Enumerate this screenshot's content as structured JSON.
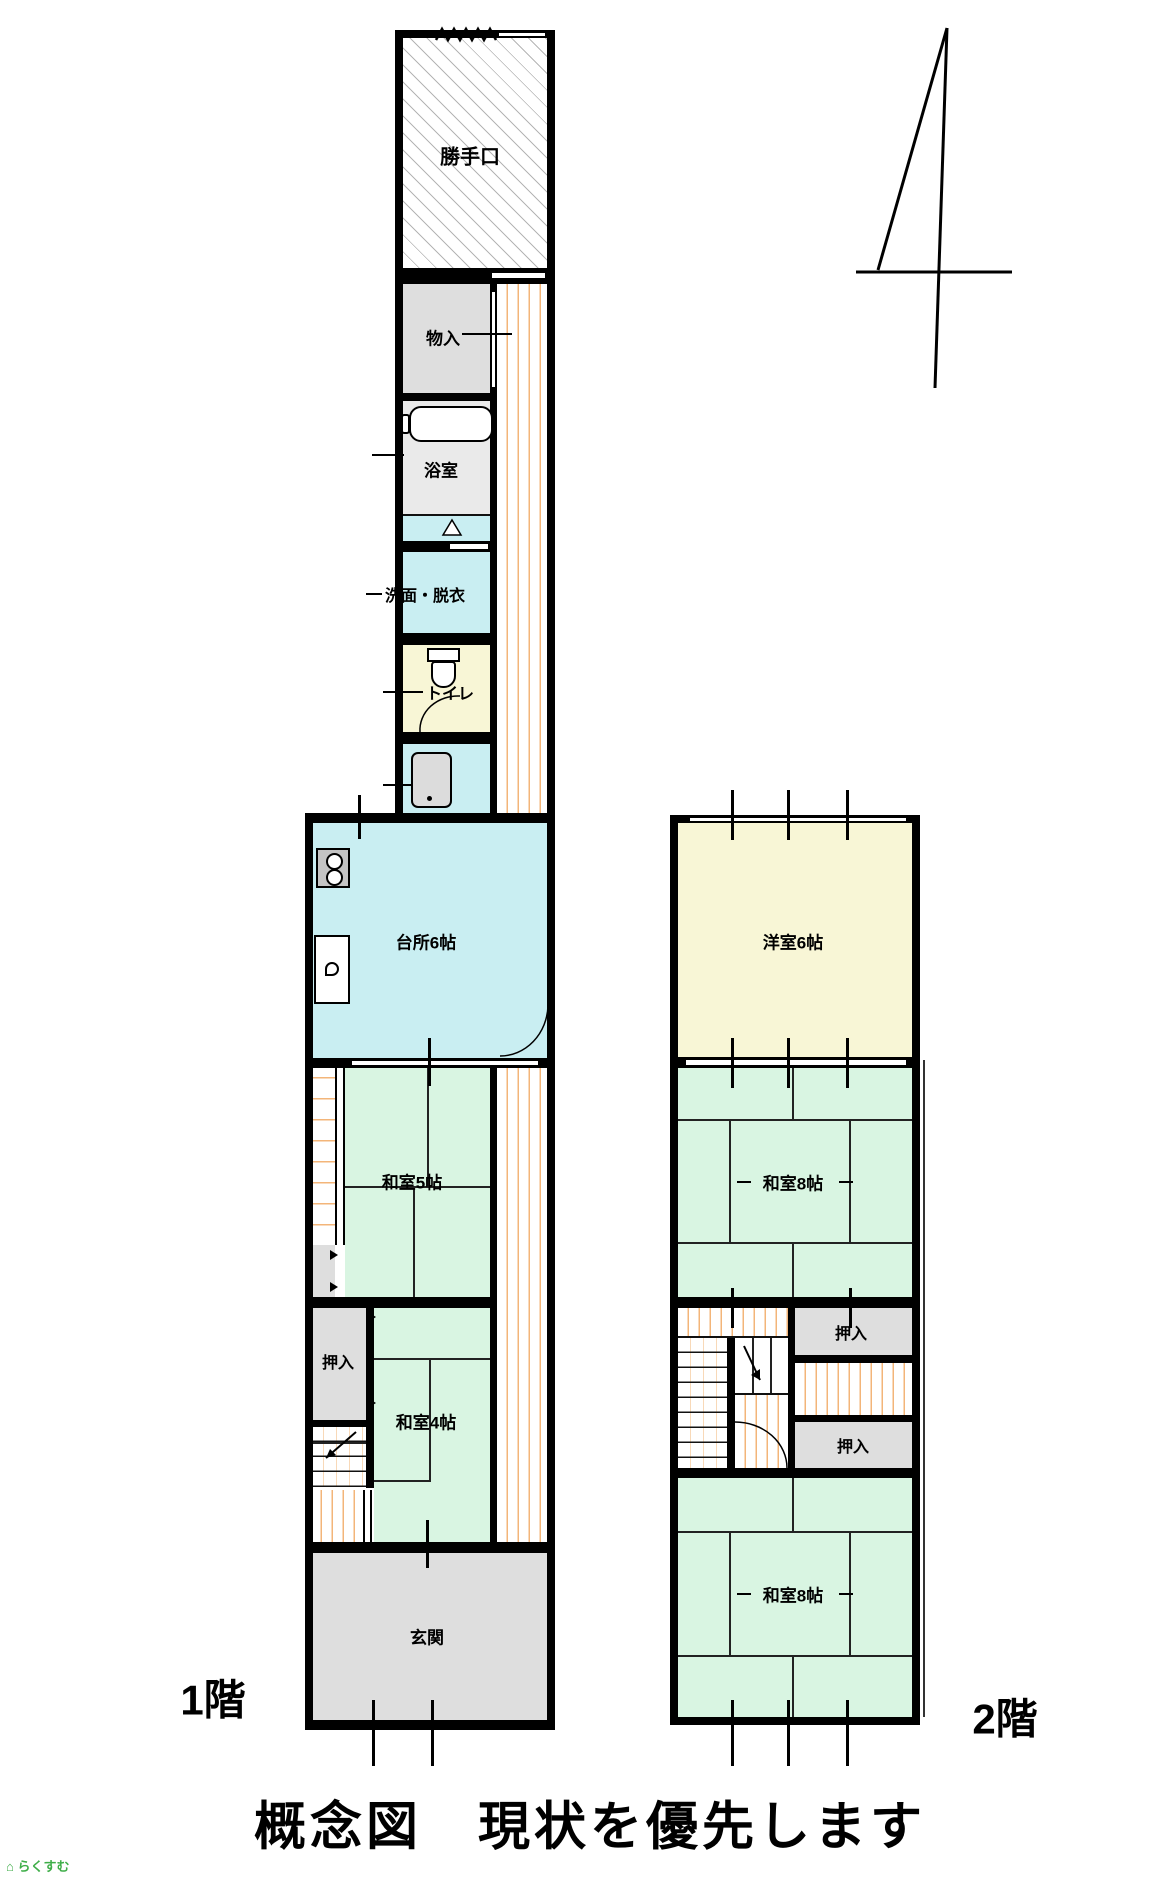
{
  "page": {
    "title": "概念図　現状を優先します",
    "floor1_label": "1階",
    "floor2_label": "2階",
    "logo_text": "らくすむ"
  },
  "floor1": {
    "rooms": {
      "katteguchi": "勝手口",
      "monoire": "物入",
      "yokushitsu": "浴室",
      "senmen_datsui": "洗面・脱衣",
      "toire": "トイレ",
      "daidokoro": "台所6帖",
      "washitsu5": "和室5帖",
      "oshiire": "押入",
      "washitsu4": "和室4帖",
      "genkan": "玄関"
    }
  },
  "floor2": {
    "rooms": {
      "youshitsu6": "洋室6帖",
      "washitsu8_upper": "和室8帖",
      "oshiire_upper": "押入",
      "oshiire_lower": "押入",
      "washitsu8_lower": "和室8帖"
    }
  },
  "icons": {
    "north_arrow": "survey-style north arrow (vertical, diagonal and cross strokes)",
    "bathtub": "rounded-rectangle tub outline",
    "toilet": "tank + bowl outline",
    "stove": "two-burner cooktop",
    "sink": "kitchen sink counter",
    "laundry": "washbasin / laundry unit",
    "stairs": "tread lines with direction arrow",
    "door_arc": "quarter-circle door swing"
  },
  "colors": {
    "wall": "#000000",
    "tatami_green": "#d9f5e2",
    "water_cyan": "#c9eef2",
    "room_yellow": "#f8f6d6",
    "storage_gray": "#dedede",
    "bath_gray": "#eaeaea",
    "floor_stripe_orange": "#f3b579",
    "logo_green": "#3fae49"
  }
}
